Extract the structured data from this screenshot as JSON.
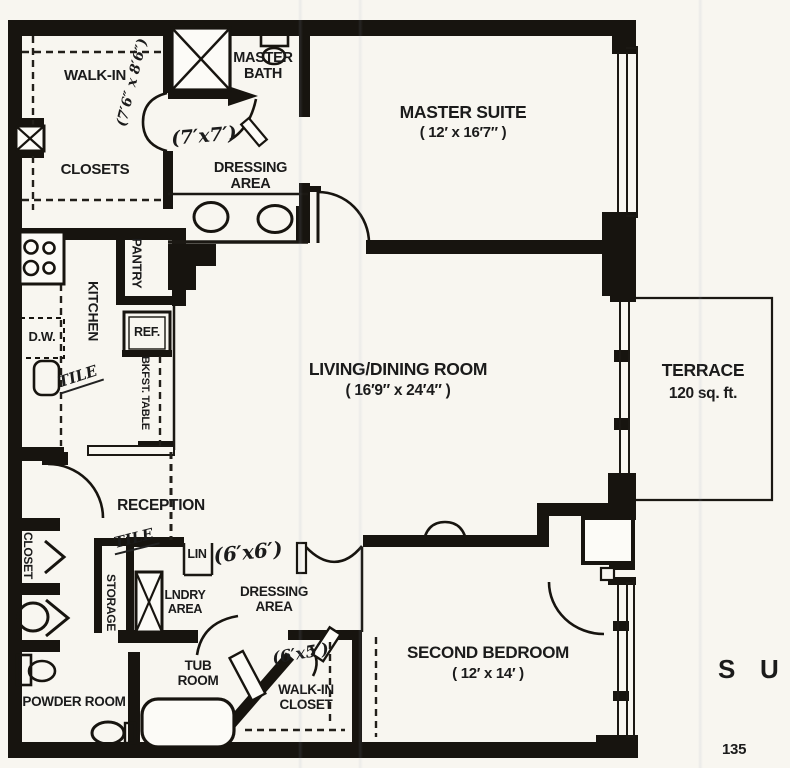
{
  "rooms": {
    "walk_in_closets": {
      "line1": "WALK-IN",
      "line2": "CLOSETS",
      "dims": "(7′6″ x 8′6″)"
    },
    "master_bath": {
      "label": "MASTER BATH"
    },
    "dressing_area_master": {
      "label": "DRESSING AREA",
      "dims": "(7′x7′)"
    },
    "master_suite": {
      "label": "MASTER SUITE",
      "dims": "( 12′ x 16′7″ )"
    },
    "kitchen": {
      "label": "KITCHEN",
      "floor_note": "TILE"
    },
    "pantry": {
      "label": "PANTRY"
    },
    "refrigerator": {
      "label": "REF."
    },
    "breakfast_table": {
      "label": "BKFST. TABLE"
    },
    "dishwasher": {
      "label": "D.W."
    },
    "living_dining_room": {
      "label": "LIVING/DINING ROOM",
      "dims": "( 16′9″ x 24′4″ )"
    },
    "terrace": {
      "label": "TERRACE",
      "area": "120 sq. ft."
    },
    "reception": {
      "label": "RECEPTION",
      "floor_note": "TILE"
    },
    "hall_closet": {
      "label": "CLOSET"
    },
    "storage": {
      "label": "STORAGE"
    },
    "linen": {
      "label": "LIN"
    },
    "laundry_area": {
      "label": "LNDRY AREA"
    },
    "dressing_area_2": {
      "label": "DRESSING AREA",
      "dims": "(6′x6′)"
    },
    "tub_room": {
      "label": "TUB ROOM"
    },
    "walk_in_closet_2": {
      "label": "WALK-IN CLOSET",
      "dims": "(6′x5′)"
    },
    "powder_room": {
      "label": "POWDER ROOM"
    },
    "second_bedroom": {
      "label": "SECOND BEDROOM",
      "dims": "( 12′ x 14′ )"
    }
  },
  "page_margin": {
    "corner_letters": "S U",
    "page_number": "135"
  }
}
